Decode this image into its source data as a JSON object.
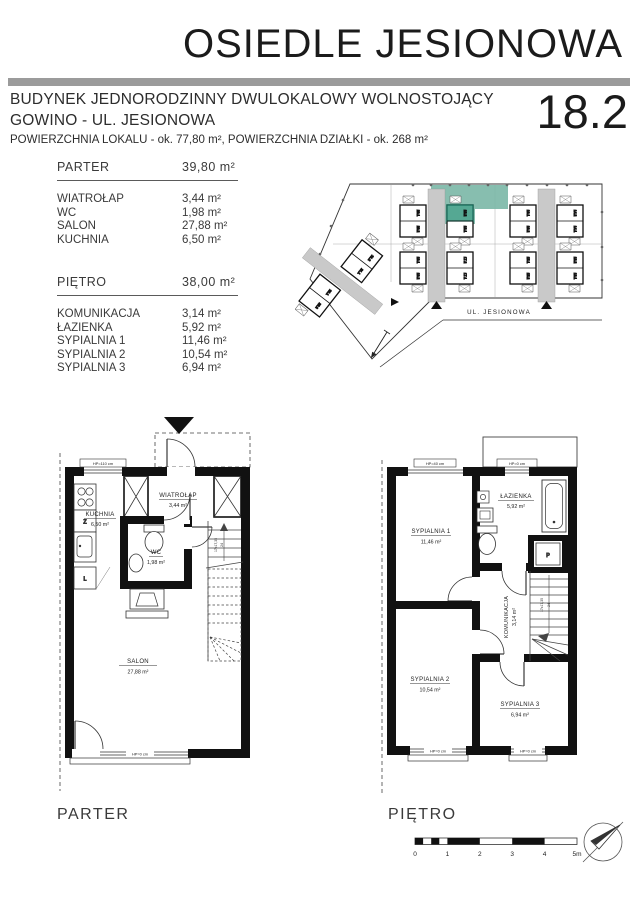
{
  "header": {
    "title": "OSIEDLE JESIONOWA",
    "subtitle_line1": "BUDYNEK JEDNORODZINNY DWULOKALOWY WOLNOSTOJĄCY",
    "subtitle_line2": "GOWINO - UL. JESIONOWA",
    "area_line": "POWIERZCHNIA LOKALU - ok. 77,80 m², POWIERZCHNIA DZIAŁKI - ok. 268 m²",
    "unit_number": "18.2"
  },
  "legend": {
    "parter": {
      "label": "PARTER",
      "total_area": "39,80 m²",
      "rooms": [
        {
          "name": "WIATROŁAP",
          "area": "3,44 m²"
        },
        {
          "name": "WC",
          "area": "1,98 m²"
        },
        {
          "name": "SALON",
          "area": "27,88 m²"
        },
        {
          "name": "KUCHNIA",
          "area": "6,50 m²"
        }
      ]
    },
    "pietro": {
      "label": "PIĘTRO",
      "total_area": "38,00 m²",
      "rooms": [
        {
          "name": "KOMUNIKACJA",
          "area": "3,14 m²"
        },
        {
          "name": "ŁAZIENKA",
          "area": "5,92 m²"
        },
        {
          "name": "SYPIALNIA 1",
          "area": "11,46 m²"
        },
        {
          "name": "SYPIALNIA 2",
          "area": "10,54 m²"
        },
        {
          "name": "SYPIALNIA 3",
          "area": "6,94 m²"
        }
      ]
    }
  },
  "site_plan": {
    "street": "UL. JESIONOWA",
    "highlight_plot_color": "#7ab7a6",
    "highlight_building_color": "#55a893",
    "units": [
      "20.1",
      "20.2",
      "18.2",
      "18.1",
      "16.1",
      "16.2",
      "14.2",
      "14.1",
      "19.1",
      "19.2",
      "17.2",
      "17.1",
      "15.1",
      "15.2",
      "13.2",
      "13.1",
      "21.2",
      "21.1",
      "22.1",
      "22.2"
    ]
  },
  "parter_plan": {
    "rooms": {
      "wiatrolap": {
        "name": "WIATROŁAP",
        "area": "3,44 m²"
      },
      "kuchnia": {
        "name": "KUCHNIA",
        "area": "6,50 m²"
      },
      "wc": {
        "name": "WC",
        "area": "1,98 m²"
      },
      "salon": {
        "name": "SALON",
        "area": "27,88 m²"
      }
    },
    "window_top": "HP=110 cm",
    "window_bottom": "HP=0 cm",
    "stair_note": "17x17,35",
    "stair_note2": "24",
    "appliance_z": "Z",
    "appliance_l": "L"
  },
  "pietro_plan": {
    "rooms": {
      "sypialnia1": {
        "name": "SYPIALNIA 1",
        "area": "11,46 m²"
      },
      "lazienka": {
        "name": "ŁAZIENKA",
        "area": "5,92 m²"
      },
      "komunikacja": {
        "name": "KOMUNIKACJA",
        "area": "3,14 m²"
      },
      "sypialnia2": {
        "name": "SYPIALNIA 2",
        "area": "10,54 m²"
      },
      "sypialnia3": {
        "name": "SYPIALNIA 3",
        "area": "6,94 m²"
      }
    },
    "window_s1": "HP=40 cm",
    "window_bath": "HP=0 cm",
    "window_s2": "HP=0 cm",
    "window_s3": "HP=0 cm",
    "stair_note": "17x17,35",
    "stair_note2": "24",
    "washer": "P"
  },
  "footer": {
    "parter_label": "PARTER",
    "pietro_label": "PIĘTRO",
    "scale_ticks": [
      "0",
      "1",
      "2",
      "3",
      "4",
      "5m"
    ]
  }
}
